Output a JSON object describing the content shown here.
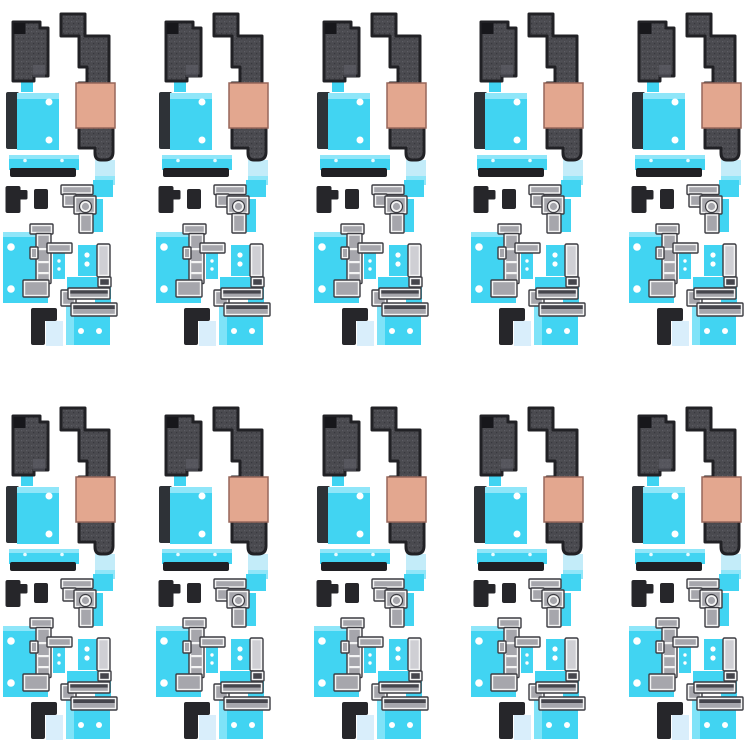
{
  "image": {
    "width_px": 750,
    "height_px": 750,
    "background": "#ffffff",
    "content": "grid of identical phone motherboard adhesive sticker sets"
  },
  "grid": {
    "rows": 2,
    "columns": 5,
    "total_sets": 10,
    "column_offsets_px": [
      0,
      153,
      311,
      468,
      626
    ],
    "row_offsets_px": [
      0,
      394
    ]
  },
  "palette": {
    "background": "#ffffff",
    "graphite": "#4a4a4f",
    "graphite_dark": "#212125",
    "graphite_speck_light": "#5d5d64",
    "graphite_speck_dark": "#38383e",
    "graphite_corner_black": "#17171b",
    "graphite_patch_light": "#616169",
    "black_piece": "#26262a",
    "copper": "#e3a78f",
    "copper_border": "#97675a",
    "cyan": "#41d4f2",
    "cyan_light": "#8fe6f9",
    "cyan_pale": "#c3ecf9",
    "pale_blue": "#d9eefb",
    "bracket_face": "#f4f4f4",
    "bracket_fill": "#a6a6ac",
    "bracket_fill_dark": "#45454c",
    "bracket_rail_light": "#cfcfd4",
    "outline_dark": "#3c3c42",
    "dot_white": "#ffffff",
    "black_bar": "#202024",
    "black_edge_bar": "#2e3237"
  },
  "sticker_set": {
    "pieces": [
      "graphite-heat-pad-sticker",
      "graphite-shield-sticker-with-copper-band",
      "cyan-pad-black-edge-sticker",
      "cyan-strip-with-black-bar-sticker",
      "black-flag-sticker",
      "black-square-sticker",
      "corner-bracket-circle-sticker",
      "cyan-plate-with-tall-bracket-sticker",
      "small-bracket-cyan-tab-sticker",
      "cyan-pad-with-rail-sticker",
      "bottom-cyan-plate-sticker",
      "bottom-rail-cluster-sticker",
      "black-corner-sticker-with-pale-tab"
    ]
  }
}
